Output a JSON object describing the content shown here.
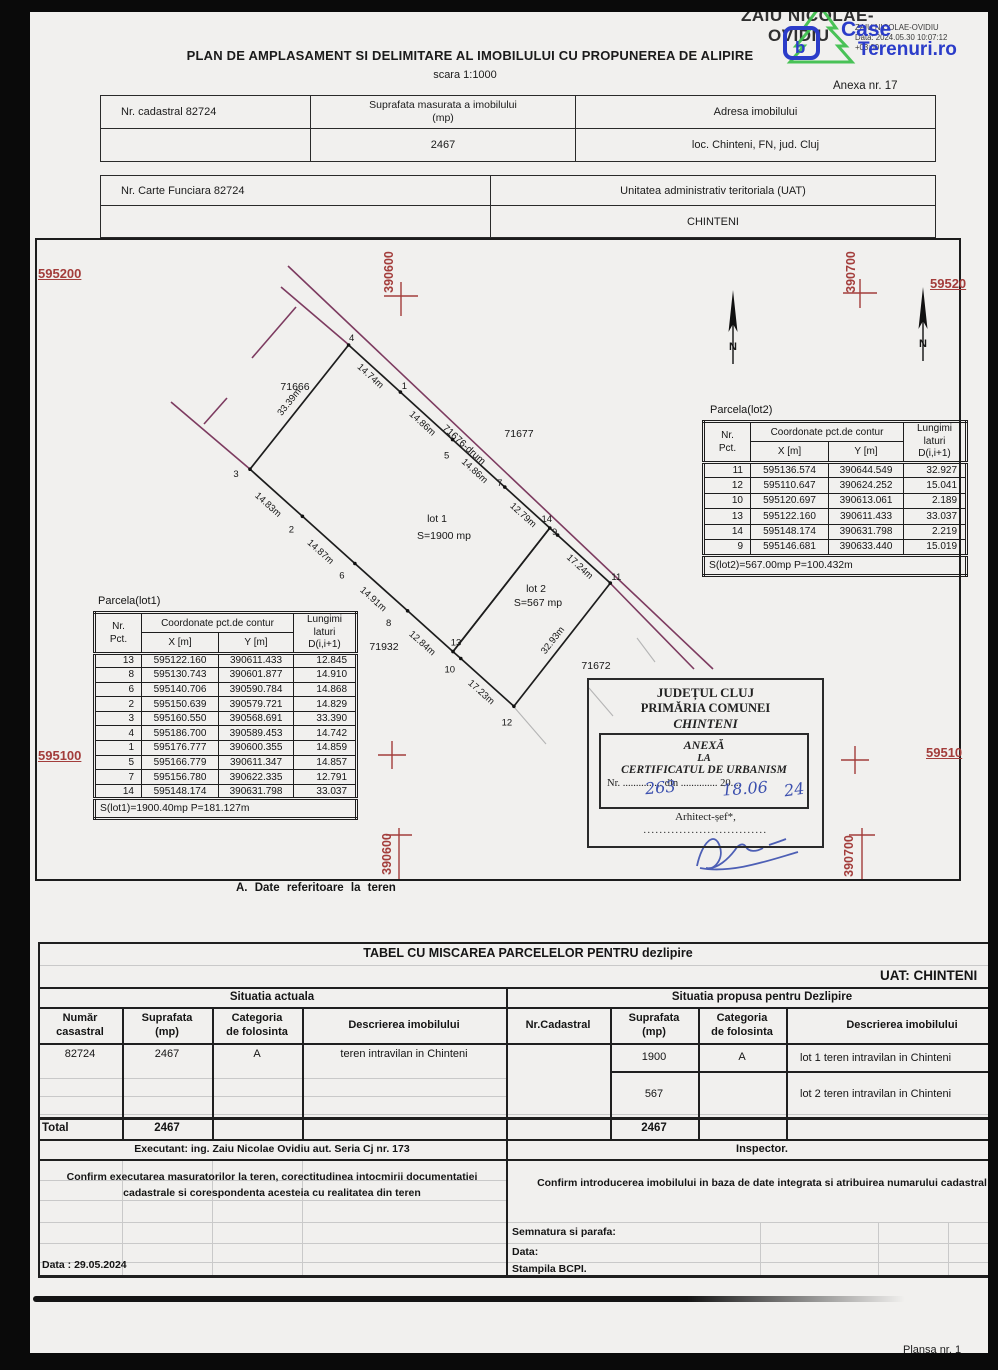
{
  "signature_stamp": {
    "name_line1": "ZAIU NICOLAE-",
    "name_line2": "OVIDIU",
    "small_line1": "ZAIU NICOLAE-OVIDIU",
    "small_line2": "Data: 2024.05.30 10:07:12",
    "small_line3": "+03:00"
  },
  "watermark": {
    "word1": "Case",
    "word2": "Terenuri.ro",
    "blue": "#2b3cc9",
    "green": "#3fbf4e"
  },
  "header": {
    "title": "PLAN DE AMPLASAMENT SI DELIMITARE AL IMOBILULUI CU PROPUNEREA DE ALIPIRE",
    "scale": "scara 1:1000",
    "annex": "Anexa nr. 17"
  },
  "info_table_1": {
    "col1": "Nr. cadastral 82724",
    "col2": "Suprafata masurata a imobilului\n(mp)",
    "col3": "Adresa imobilului",
    "val2": "2467",
    "val3": "loc. Chinteni, FN,  jud. Cluj"
  },
  "info_table_2": {
    "col1": "Nr. Carte Funciara 82724",
    "col2": "Unitatea administrativ teritoriala (UAT)",
    "val2": "CHINTENI"
  },
  "map": {
    "caption": "A. Date referitoare la teren",
    "north_label": "N",
    "grid_labels": {
      "left_top": "595200",
      "left_bottom": "595100",
      "right_top": "59520",
      "right_bottom": "59510",
      "east_top_left": "390600",
      "east_top_right": "390700",
      "east_bottom_left": "390600",
      "east_bottom_right": "390700"
    },
    "road_label": "71676-drum",
    "neighbor_labels": [
      "71666",
      "71677",
      "71932",
      "71672"
    ],
    "lot1_label": {
      "name": "lot 1",
      "area": "S=1900 mp"
    },
    "lot2_label": {
      "name": "lot 2",
      "area": "S=567 mp"
    },
    "edge_lengths": [
      {
        "from": "3",
        "to": "4",
        "label": "33.39m"
      },
      {
        "from": "4",
        "to": "1",
        "label": "14.74m"
      },
      {
        "from": "1",
        "to": "5",
        "label": "14.86m"
      },
      {
        "from": "5",
        "to": "7",
        "label": "14.86m"
      },
      {
        "from": "7",
        "to": "14",
        "label": "12.79m"
      },
      {
        "from": "9",
        "to": "11",
        "label": "17.24m"
      },
      {
        "from": "11",
        "to": "12",
        "label": "32.93m"
      },
      {
        "from": "12",
        "to": "10",
        "label": "17.23m"
      },
      {
        "from": "13",
        "to": "8",
        "label": "12.84m"
      },
      {
        "from": "8",
        "to": "6",
        "label": "14.91m"
      },
      {
        "from": "6",
        "to": "2",
        "label": "14.87m"
      },
      {
        "from": "2",
        "to": "3",
        "label": "14.83m"
      }
    ]
  },
  "parcel_table_lot1": {
    "title": "Parcela(lot1)",
    "header": {
      "nr": "Nr.\nPct.",
      "coord": "Coordonate pct.de contur",
      "x": "X [m]",
      "y": "Y [m]",
      "len": "Lungimi\nlaturi\nD(i,i+1)"
    },
    "rows": [
      [
        "13",
        "595122.160",
        "390611.433",
        "12.845"
      ],
      [
        "8",
        "595130.743",
        "390601.877",
        "14.910"
      ],
      [
        "6",
        "595140.706",
        "390590.784",
        "14.868"
      ],
      [
        "2",
        "595150.639",
        "390579.721",
        "14.829"
      ],
      [
        "3",
        "595160.550",
        "390568.691",
        "33.390"
      ],
      [
        "4",
        "595186.700",
        "390589.453",
        "14.742"
      ],
      [
        "1",
        "595176.777",
        "390600.355",
        "14.859"
      ],
      [
        "5",
        "595166.779",
        "390611.347",
        "14.857"
      ],
      [
        "7",
        "595156.780",
        "390622.335",
        "12.791"
      ],
      [
        "14",
        "595148.174",
        "390631.798",
        "33.037"
      ]
    ],
    "footer": "S(lot1)=1900.40mp  P=181.127m"
  },
  "parcel_table_lot2": {
    "title": "Parcela(lot2)",
    "header": {
      "nr": "Nr.\nPct.",
      "coord": "Coordonate pct.de contur",
      "x": "X [m]",
      "y": "Y [m]",
      "len": "Lungimi\nlaturi\nD(i,i+1)"
    },
    "rows": [
      [
        "11",
        "595136.574",
        "390644.549",
        "32.927"
      ],
      [
        "12",
        "595110.647",
        "390624.252",
        "15.041"
      ],
      [
        "10",
        "595120.697",
        "390613.061",
        "2.189"
      ],
      [
        "13",
        "595122.160",
        "390611.433",
        "33.037"
      ],
      [
        "14",
        "595148.174",
        "390631.798",
        "2.219"
      ],
      [
        "9",
        "595146.681",
        "390633.440",
        "15.019"
      ]
    ],
    "footer": "S(lot2)=567.00mp  P=100.432m"
  },
  "stamp": {
    "line1": "JUDEȚUL CLUJ",
    "line2": "PRIMĂRIA COMUNEI",
    "line3": "CHINTENI",
    "anexa1": "ANEXĂ",
    "anexa2": "LA",
    "anexa3": "CERTIFICATUL DE URBANISM",
    "nr_line": "Nr. ............... din .............. 20....",
    "hand_nr": "263",
    "hand_din": "18.06",
    "hand_year": "24",
    "arhitect": "Arhitect-șef*,",
    "dots": "..............................."
  },
  "movement_table": {
    "title": "TABEL CU MISCAREA PARCELELOR PENTRU dezlipire",
    "uat": "UAT: CHINTENI",
    "group_left": "Situatia actuala",
    "group_right": "Situatia propusa pentru Dezlipire",
    "headers_left": [
      "Număr\ncasastral",
      "Suprafata\n(mp)",
      "Categoria\nde folosinta",
      "Descrierea imobilului"
    ],
    "headers_right": [
      "Nr.Cadastral",
      "Suprafata\n(mp)",
      "Categoria\nde folosinta",
      "Descrierea imobilului"
    ],
    "row_current": [
      "82724",
      "2467",
      "A",
      "teren intravilan in Chinteni"
    ],
    "proposed": [
      {
        "suprafata": "1900",
        "categoria": "A",
        "descriere": "lot 1 teren intravilan in Chinteni"
      },
      {
        "suprafata": "567",
        "categoria": "",
        "descriere": "lot 2 teren intravilan in Chinteni"
      }
    ],
    "total_label": "Total",
    "total_current": "2467",
    "total_proposed": "2467",
    "executant": "Executant: ing. Zaiu Nicolae Ovidiu aut. Seria Cj nr. 173",
    "inspector": "Inspector.",
    "confirm_left": "Confirm executarea masuratorilor la teren, corectitudinea intocmirii documentatiei cadastrale si corespondenta acesteia cu realitatea din teren",
    "confirm_right": "Confirm introducerea imobilului in baza de date integrata si atribuirea numarului cadastral",
    "semnatura": "Semnatura si parafa:",
    "data_right": "Data:",
    "stampila": "Stampila BCPI.",
    "data_left": "Data : 29.05.2024",
    "plansa": "Plansa nr. 1"
  }
}
